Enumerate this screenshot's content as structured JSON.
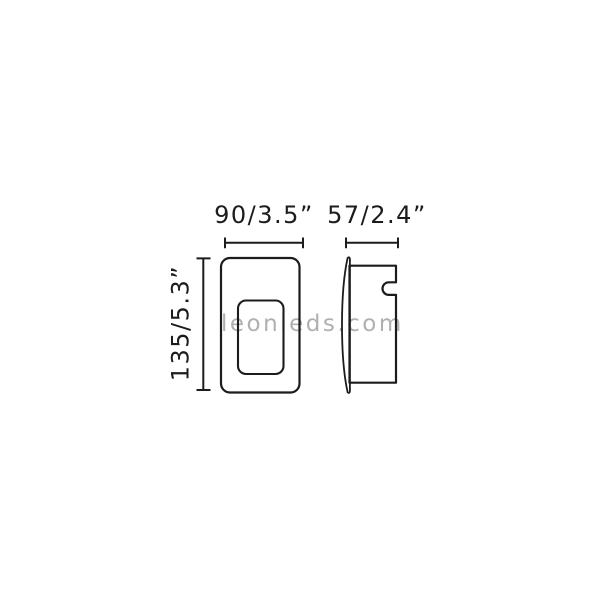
{
  "canvas": {
    "background": "#ffffff",
    "line_color": "#1c1c1c",
    "text_color": "#1c1c1c"
  },
  "labels": {
    "front_width": "90/3.5”",
    "side_depth": "57/2.4”",
    "height": "135/5.3”"
  },
  "watermark": {
    "text": "leonleds.com",
    "color": "#b0b0b0"
  }
}
